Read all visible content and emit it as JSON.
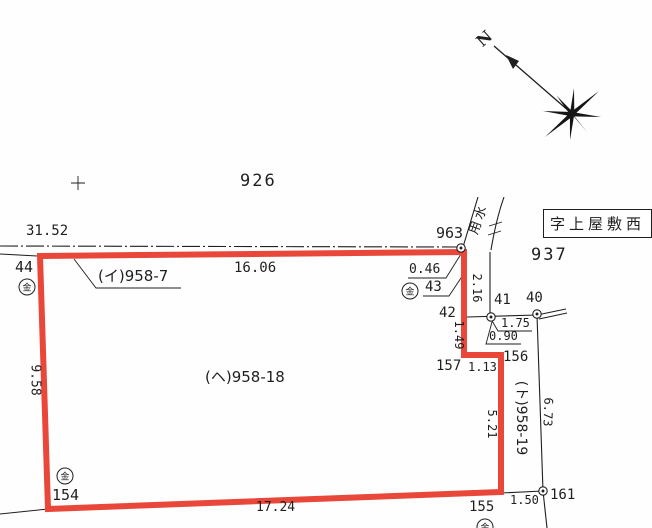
{
  "compass": {
    "north": "N"
  },
  "district_label": "字上屋敷西",
  "parcels": {
    "p926": "926",
    "p937": "937",
    "main": "(ヘ)958-18",
    "west": "(イ)958-7",
    "east_vertical": "(ト)958-19",
    "waterway": "用水"
  },
  "points": {
    "p44": "44",
    "p963": "963",
    "p43": "43",
    "p42": "42",
    "p41": "41",
    "p40": "40",
    "p157": "157",
    "p156": "156",
    "p154": "154",
    "p155": "155",
    "p161": "161"
  },
  "measurements": {
    "m31_52": "31.52",
    "m16_06": "16.06",
    "m0_46": "0.46",
    "m2_16": "2.16",
    "m1_49": "1.49",
    "m1_75": "1.75",
    "m0_90": "0.90",
    "m1_13": "1.13",
    "m5_21": "5.21",
    "m6_73": "6.73",
    "m9_58": "9.58",
    "m17_24": "17.24",
    "m1_50": "1.50"
  },
  "marker_glyph": "金",
  "colors": {
    "parcel_outline": "#e8473a",
    "ink": "#1f1f1f",
    "background": "#ffffff"
  }
}
